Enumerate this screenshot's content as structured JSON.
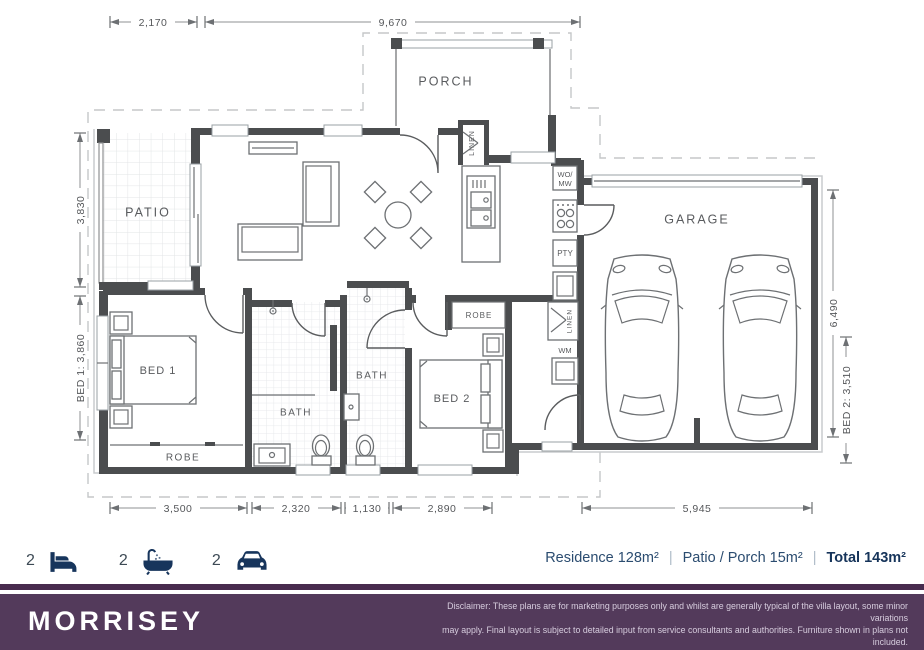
{
  "plan": {
    "rooms": {
      "porch": "PORCH",
      "patio": "PATIO",
      "garage": "GARAGE",
      "bed1": "BED 1",
      "bed2": "BED 2",
      "bath1": "BATH",
      "bath2": "BATH",
      "robe1": "ROBE",
      "robe2": "ROBE",
      "linen1": "LINEN",
      "linen2": "LINEN",
      "womw_line1": "WO/",
      "womw_line2": "MW",
      "pty": "PTY",
      "wm": "WM"
    },
    "dimensions": {
      "top_patio": "2,170",
      "top_house": "9,670",
      "left_patio": "3,830",
      "left_bed1": "BED 1: 3,860",
      "right_garage": "6,490",
      "right_bed2": "BED 2: 3,510",
      "bottom_1": "3,500",
      "bottom_2": "2,320",
      "bottom_3": "1,130",
      "bottom_4": "2,890",
      "bottom_5": "5,945"
    }
  },
  "summary": {
    "bed_count": "2",
    "bath_count": "2",
    "car_count": "2",
    "residence": "Residence 128m²",
    "patio_porch": "Patio / Porch 15m²",
    "total": "Total 143m²",
    "sep": "|"
  },
  "footer": {
    "brand": "MORRISEY",
    "disclaimer_line1": "Disclaimer: These plans are for marketing purposes only and whilst are generally typical of the villa layout, some minor variations",
    "disclaimer_line2": "may apply. Final layout is subject to detailed input from service consultants and authorities. Furniture shown in plans not included.",
    "disclaimer_line3": "External fixtures may differ from this plan. Total area is indicative only as measured to internal face of the external wall."
  },
  "colors": {
    "wall": "#4b4d4f",
    "navy_icon": "#17355c",
    "area_text": "#2b4c70",
    "purple_bar": "#533a5b",
    "purple_stripe": "#482b4e",
    "label_gray": "#595b5e"
  }
}
